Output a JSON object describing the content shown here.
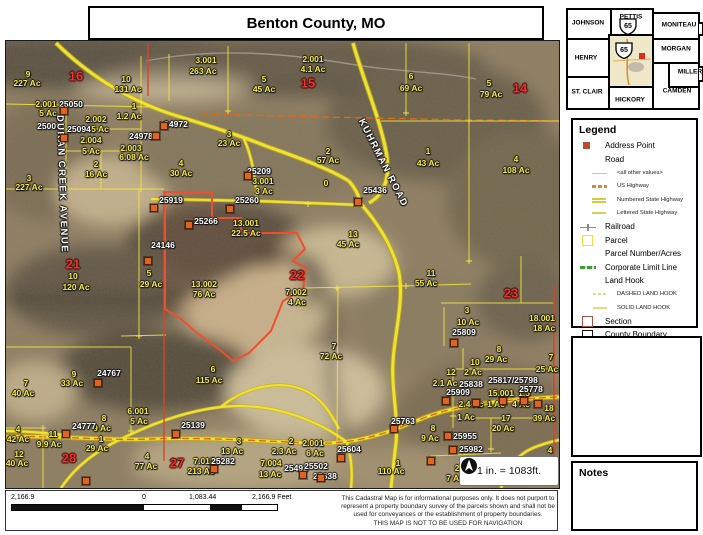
{
  "title": "Benton County, MO",
  "notes_title": "Notes",
  "scale_note": "1 in. = 1083ft.",
  "inset": {
    "counties": [
      "JOHNSON",
      "PETTIS",
      "MONITEAU",
      "HENRY",
      "MORGAN",
      "MILLER",
      "ST. CLAIR",
      "HICKORY",
      "CAMDEN"
    ],
    "highway_shield": "65",
    "highlight_color": "#efe8c8",
    "marker_color": "#e02a1c"
  },
  "legend": {
    "title": "Legend",
    "items": [
      {
        "label": "Address Point",
        "swatch": "addr"
      },
      {
        "label": "Road",
        "swatch": "none"
      },
      {
        "label": "<all other values>",
        "swatch": "thinline",
        "small": true,
        "indent": true
      },
      {
        "label": "US Highway",
        "swatch": "ushwy",
        "small": true,
        "indent": true
      },
      {
        "label": "Numbered State Highway",
        "swatch": "numhwy",
        "small": true,
        "indent": true
      },
      {
        "label": "Lettered State Highway",
        "swatch": "lethwy",
        "small": true,
        "indent": true
      },
      {
        "label": "Railroad",
        "swatch": "rail"
      },
      {
        "label": "Parcel",
        "swatch": "parcel"
      },
      {
        "label": "Parcel Number/Acres",
        "swatch": "none"
      },
      {
        "label": "Corporate Limit Line",
        "swatch": "corp"
      },
      {
        "label": "Land Hook",
        "swatch": "none"
      },
      {
        "label": "DASHED LAND HOOK",
        "swatch": "dhook",
        "small": true,
        "indent": true
      },
      {
        "label": "SOLID LAND HOOK",
        "swatch": "shook",
        "small": true,
        "indent": true
      },
      {
        "label": "Section",
        "swatch": "section"
      },
      {
        "label": "County Boundary",
        "swatch": "county"
      }
    ]
  },
  "scalebar": {
    "neg": "2,166.9",
    "zero": "0",
    "mid": "1,083.44",
    "end": "2,166.9 Feet"
  },
  "disclaimer": {
    "line1": "This Cadastral Map is for informational purposes only.  It does not purport to",
    "line2": "represent a property boundary survey of the parcels shown and shall not be",
    "line3": "used for conveyances or the establishment of property boundaries.",
    "line4": "THIS MAP IS NOT TO BE USED FOR NAVIGATION"
  },
  "map": {
    "accent_colors": {
      "parcel_line": "#f3e63c",
      "section_line": "#d6452b",
      "highlight_parcel": "#ef4f2e",
      "us_highway_dash": "#e06a14"
    },
    "labels": [
      [
        "9",
        22,
        33,
        "p"
      ],
      [
        "227 Ac",
        21,
        42,
        "p"
      ],
      [
        "10",
        120,
        38,
        "p"
      ],
      [
        "131 Ac",
        122,
        48,
        "p"
      ],
      [
        "2.001",
        40,
        63,
        "p"
      ],
      [
        "5 Ac",
        42,
        72,
        "p"
      ],
      [
        "2.002",
        90,
        78,
        "p"
      ],
      [
        "5 Ac",
        94,
        88,
        "p"
      ],
      [
        "1",
        128,
        65,
        "p"
      ],
      [
        "1.2 Ac",
        123,
        75,
        "p"
      ],
      [
        "2.004",
        85,
        99,
        "p"
      ],
      [
        "5 Ac",
        85,
        110,
        "p"
      ],
      [
        "2.003",
        125,
        107,
        "p"
      ],
      [
        "6.08 Ac",
        128,
        116,
        "p"
      ],
      [
        "2",
        90,
        123,
        "p"
      ],
      [
        "16 Ac",
        90,
        133,
        "p"
      ],
      [
        "4",
        175,
        122,
        "p"
      ],
      [
        "30 Ac",
        175,
        132,
        "p"
      ],
      [
        "3",
        23,
        137,
        "p"
      ],
      [
        "227 Ac",
        23,
        146,
        "p"
      ],
      [
        "3.001",
        200,
        19,
        "p"
      ],
      [
        "263 Ac",
        197,
        30,
        "p"
      ],
      [
        "5",
        258,
        38,
        "p"
      ],
      [
        "45 Ac",
        258,
        48,
        "p"
      ],
      [
        "2.001",
        307,
        18,
        "p"
      ],
      [
        "4.1 Ac",
        307,
        28,
        "p"
      ],
      [
        "3",
        223,
        93,
        "p"
      ],
      [
        "23 Ac",
        223,
        102,
        "p"
      ],
      [
        "3.001",
        257,
        140,
        "p"
      ],
      [
        "3 Ac",
        258,
        150,
        "p"
      ],
      [
        "2",
        322,
        110,
        "p"
      ],
      [
        "57 Ac",
        322,
        119,
        "p"
      ],
      [
        "0",
        320,
        142,
        "p"
      ],
      [
        "6",
        405,
        35,
        "p"
      ],
      [
        "69 Ac",
        405,
        47,
        "p"
      ],
      [
        "5",
        483,
        42,
        "p"
      ],
      [
        "79 Ac",
        485,
        53,
        "p"
      ],
      [
        "1",
        422,
        110,
        "p"
      ],
      [
        "43 Ac",
        422,
        122,
        "p"
      ],
      [
        "4",
        510,
        118,
        "p"
      ],
      [
        "108 Ac",
        510,
        129,
        "p"
      ],
      [
        "13.001",
        240,
        182,
        "p"
      ],
      [
        "22.5 Ac",
        240,
        192,
        "p"
      ],
      [
        "5",
        143,
        232,
        "p"
      ],
      [
        "29 Ac",
        145,
        243,
        "p"
      ],
      [
        "10",
        67,
        235,
        "p"
      ],
      [
        "120 Ac",
        70,
        246,
        "p"
      ],
      [
        "13.002",
        198,
        243,
        "p"
      ],
      [
        "76 Ac",
        198,
        253,
        "p"
      ],
      [
        "13",
        347,
        193,
        "p"
      ],
      [
        "45 Ac",
        342,
        203,
        "p"
      ],
      [
        "11",
        425,
        232,
        "p"
      ],
      [
        "55 Ac",
        420,
        242,
        "p"
      ],
      [
        "7.002",
        290,
        251,
        "p"
      ],
      [
        "4 Ac",
        291,
        261,
        "p"
      ],
      [
        "3",
        461,
        269,
        "p"
      ],
      [
        "10 Ac",
        462,
        281,
        "p"
      ],
      [
        "18.001",
        536,
        277,
        "p"
      ],
      [
        "18 Ac",
        538,
        287,
        "p"
      ],
      [
        "8",
        493,
        308,
        "p"
      ],
      [
        "29 Ac",
        490,
        318,
        "p"
      ],
      [
        "7",
        545,
        316,
        "p"
      ],
      [
        "25 Ac",
        541,
        328,
        "p"
      ],
      [
        "10",
        469,
        321,
        "p"
      ],
      [
        "2 Ac",
        467,
        331,
        "p"
      ],
      [
        "12",
        445,
        331,
        "p"
      ],
      [
        "2.1 Ac",
        439,
        342,
        "p"
      ],
      [
        "15.001",
        495,
        352,
        "p"
      ],
      [
        "1.5",
        518,
        352,
        "p"
      ],
      [
        "2.4 Ac",
        465,
        363,
        "p"
      ],
      [
        "1 Ac",
        490,
        363,
        "p"
      ],
      [
        "4 Ac",
        515,
        363,
        "p"
      ],
      [
        "1 Ac",
        460,
        376,
        "p"
      ],
      [
        "17",
        500,
        377,
        "p"
      ],
      [
        "20 Ac",
        497,
        387,
        "p"
      ],
      [
        "18",
        543,
        367,
        "p"
      ],
      [
        "39 Ac",
        538,
        377,
        "p"
      ],
      [
        "8",
        427,
        387,
        "p"
      ],
      [
        "9 Ac",
        424,
        397,
        "p"
      ],
      [
        "4",
        544,
        409,
        "p"
      ],
      [
        "2",
        451,
        427,
        "p"
      ],
      [
        "7 Ac",
        449,
        437,
        "p"
      ],
      [
        "7",
        20,
        342,
        "p"
      ],
      [
        "40 Ac",
        17,
        352,
        "p"
      ],
      [
        "9",
        68,
        333,
        "p"
      ],
      [
        "33 Ac",
        66,
        342,
        "p"
      ],
      [
        "4",
        12,
        388,
        "p"
      ],
      [
        "42 Ac",
        12,
        398,
        "p"
      ],
      [
        "12",
        13,
        413,
        "p"
      ],
      [
        "40 Ac",
        11,
        422,
        "p"
      ],
      [
        "11",
        47,
        393,
        "p"
      ],
      [
        "9.9 Ac",
        43,
        403,
        "p"
      ],
      [
        "8",
        98,
        377,
        "p"
      ],
      [
        "9 Ac",
        96,
        387,
        "p"
      ],
      [
        "6.001",
        132,
        370,
        "p"
      ],
      [
        "5 Ac",
        133,
        380,
        "p"
      ],
      [
        "1",
        95,
        398,
        "p"
      ],
      [
        "29 Ac",
        91,
        407,
        "p"
      ],
      [
        "4",
        141,
        415,
        "p"
      ],
      [
        "77 Ac",
        140,
        425,
        "p"
      ],
      [
        "6",
        207,
        328,
        "p"
      ],
      [
        "115 Ac",
        203,
        339,
        "p"
      ],
      [
        "7",
        328,
        305,
        "p"
      ],
      [
        "72 Ac",
        325,
        315,
        "p"
      ],
      [
        "3",
        233,
        400,
        "p"
      ],
      [
        "13 Ac",
        226,
        410,
        "p"
      ],
      [
        "2",
        285,
        400,
        "p"
      ],
      [
        "2.3 Ac",
        278,
        410,
        "p"
      ],
      [
        "2.001",
        307,
        402,
        "p"
      ],
      [
        "6 Ac",
        309,
        412,
        "p"
      ],
      [
        "7.013",
        198,
        420,
        "p"
      ],
      [
        "213 Ac",
        195,
        430,
        "p"
      ],
      [
        "7.004",
        265,
        422,
        "p"
      ],
      [
        "13 Ac",
        264,
        433,
        "p"
      ],
      [
        "1",
        392,
        422,
        "p"
      ],
      [
        "110 Ac",
        385,
        430,
        "p"
      ],
      [
        "25050",
        65,
        63,
        "a"
      ],
      [
        "25006",
        43,
        85,
        "a"
      ],
      [
        "25094",
        73,
        88,
        "a"
      ],
      [
        "24972",
        170,
        83,
        "a"
      ],
      [
        "24978",
        135,
        95,
        "a"
      ],
      [
        "25209",
        253,
        130,
        "a"
      ],
      [
        "25260",
        241,
        159,
        "a"
      ],
      [
        "25919",
        165,
        159,
        "a"
      ],
      [
        "25266",
        200,
        180,
        "a"
      ],
      [
        "24146",
        157,
        204,
        "a"
      ],
      [
        "25436",
        369,
        149,
        "a"
      ],
      [
        "25809",
        458,
        291,
        "a"
      ],
      [
        "25838",
        465,
        343,
        "a"
      ],
      [
        "25817/25798",
        507,
        339,
        "a"
      ],
      [
        "25778",
        525,
        348,
        "a"
      ],
      [
        "25909",
        452,
        351,
        "a"
      ],
      [
        "25955",
        459,
        395,
        "a"
      ],
      [
        "25982",
        465,
        408,
        "a"
      ],
      [
        "24767",
        103,
        332,
        "a"
      ],
      [
        "24777",
        78,
        385,
        "a"
      ],
      [
        "25139",
        187,
        384,
        "a"
      ],
      [
        "25604",
        343,
        408,
        "a"
      ],
      [
        "25763",
        397,
        380,
        "a"
      ],
      [
        "25282",
        217,
        420,
        "a"
      ],
      [
        "25492",
        290,
        427,
        "a"
      ],
      [
        "25502",
        310,
        425,
        "a"
      ],
      [
        "25638",
        319,
        435,
        "a"
      ],
      [
        "16",
        70,
        35,
        "s"
      ],
      [
        "15",
        302,
        42,
        "s"
      ],
      [
        "14",
        514,
        47,
        "s"
      ],
      [
        "21",
        67,
        223,
        "s"
      ],
      [
        "22",
        291,
        234,
        "s"
      ],
      [
        "23",
        505,
        252,
        "s"
      ],
      [
        "28",
        63,
        417,
        "s"
      ],
      [
        "27",
        171,
        422,
        "s"
      ],
      [
        "KUHRMAN ROAD",
        377,
        122,
        "rd",
        63
      ],
      [
        "DURAN CREEK AVENUE",
        56,
        143,
        "rd",
        88
      ]
    ],
    "address_points": [
      [
        58,
        70
      ],
      [
        58,
        97
      ],
      [
        150,
        95
      ],
      [
        158,
        85
      ],
      [
        242,
        135
      ],
      [
        224,
        168
      ],
      [
        183,
        184
      ],
      [
        148,
        167
      ],
      [
        142,
        220
      ],
      [
        352,
        161
      ],
      [
        448,
        302
      ],
      [
        92,
        342
      ],
      [
        60,
        393
      ],
      [
        170,
        393
      ],
      [
        208,
        428
      ],
      [
        297,
        434
      ],
      [
        315,
        437
      ],
      [
        335,
        417
      ],
      [
        388,
        388
      ],
      [
        470,
        362
      ],
      [
        497,
        360
      ],
      [
        518,
        360
      ],
      [
        532,
        363
      ],
      [
        440,
        360
      ],
      [
        442,
        395
      ],
      [
        447,
        409
      ],
      [
        425,
        420
      ],
      [
        80,
        440
      ]
    ]
  }
}
